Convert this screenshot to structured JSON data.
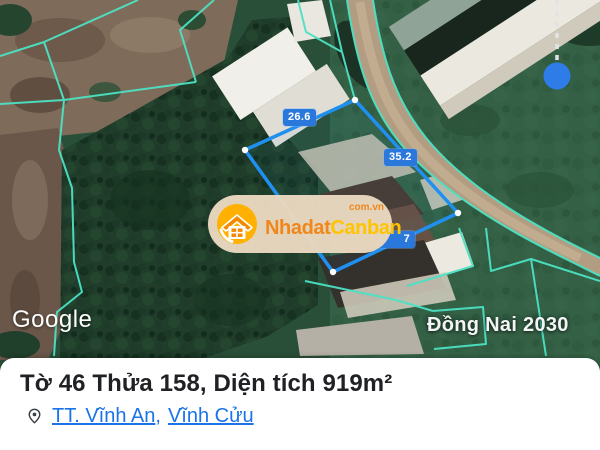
{
  "map": {
    "attribution_label": "Google",
    "plan_overlay_label": "Đồng Nai 2030",
    "measurement_labels": [
      {
        "value": "26.6"
      },
      {
        "value": "35.2"
      },
      {
        "value": "7"
      }
    ],
    "colors": {
      "parcel_outline": "#2090f0",
      "cadastral_lines": "#4ce2c4",
      "marker_dot": "#2e7ce8",
      "measurement_chip_bg": "#2b78dd"
    }
  },
  "watermark": {
    "brand_primary": "Nhadat",
    "brand_secondary": "Canban",
    "domain_suffix": "com.vn",
    "colors": {
      "pill_bg": "#e9d8bf",
      "primary_text": "#f0871a",
      "secondary_text": "#ffc400",
      "badge_bg": "#ffb000"
    }
  },
  "info_panel": {
    "title": "Tờ 46 Thửa 158, Diện tích 919m²",
    "location": {
      "link_ward": "TT. Vĩnh An",
      "separator": ",",
      "link_district": "Vĩnh Cửu"
    },
    "link_color": "#1a73e8"
  }
}
